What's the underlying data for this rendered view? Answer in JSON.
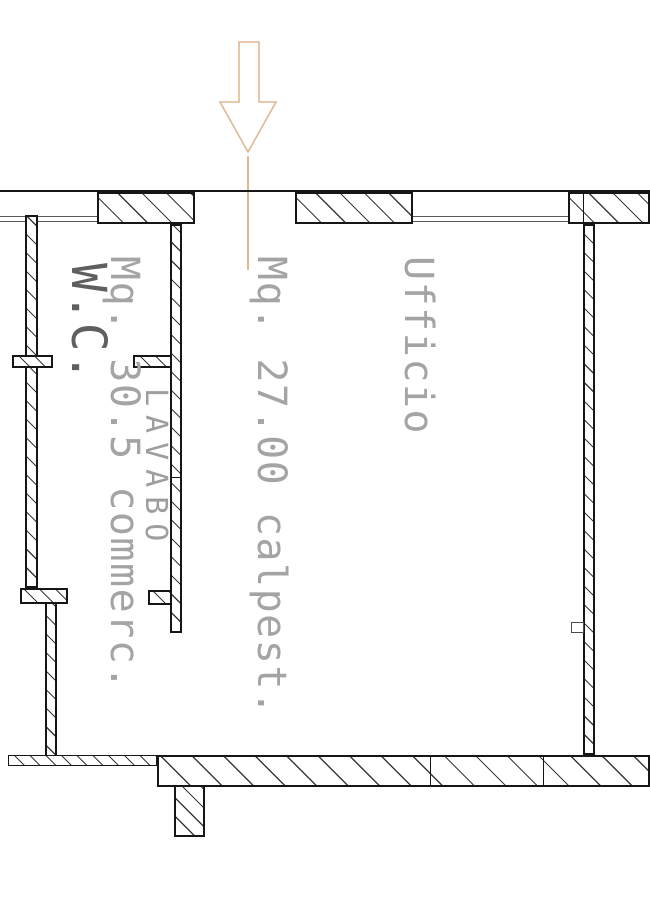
{
  "drawing": {
    "type": "architectural-floor-plan",
    "rooms": {
      "wc_label": "W.C.",
      "lavabo_label": "LAVABO",
      "office": {
        "name": "Ufficio",
        "area_walkable": "Mq. 27.00 calpest.",
        "area_commercial": "Mq. 30.5 commerc."
      }
    },
    "entrance": {
      "icon": "down-arrow",
      "arrow_color": "#dfb992"
    },
    "colors": {
      "wall_outline": "#161616",
      "hatch_lines": "#3a3a3a",
      "window_sill": "#5a5a5a",
      "office_label_gray": "#a4a4a4",
      "wc_label_gray": "#5f5f5f",
      "lavabo_label_gray": "#9e9e9e",
      "background": "#ffffff"
    }
  }
}
